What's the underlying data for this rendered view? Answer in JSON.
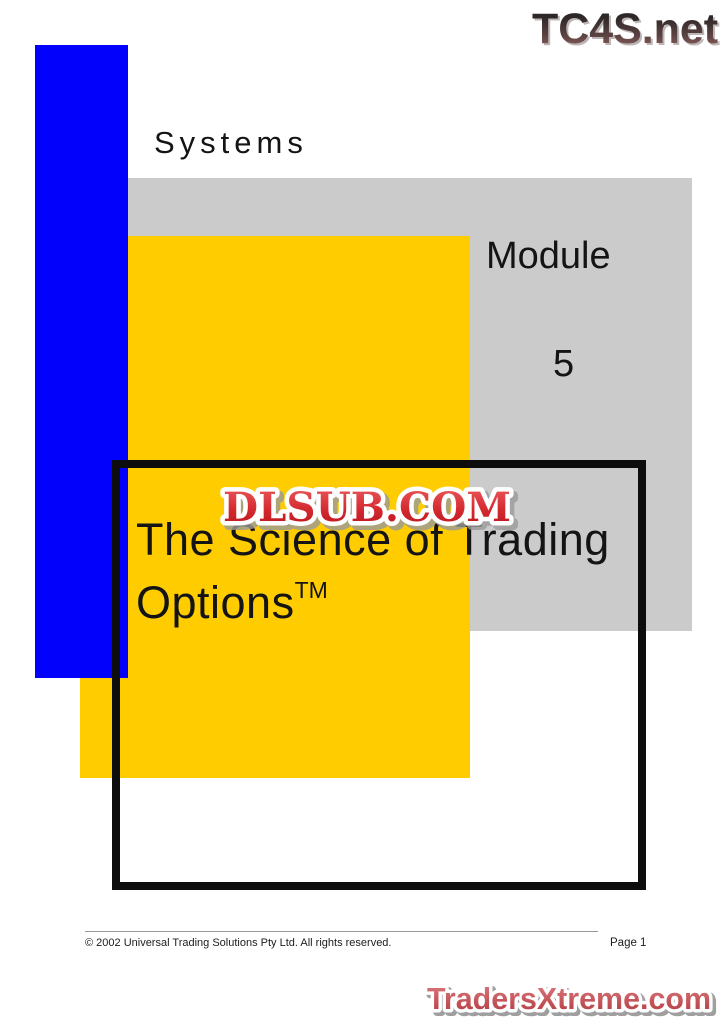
{
  "colors": {
    "accent_blue": "#0202fc",
    "accent_yellow": "#ffcc00",
    "panel_gray": "#cbcbcb",
    "frame_black": "#0d0d0d",
    "text_black": "#141414",
    "footer_gray": "#999999",
    "wm_red_light": "#e85456",
    "wm_red_dark": "#b9121a",
    "tx_red_light": "#d9767a",
    "tx_red_dark": "#b2393f",
    "tc4s_top": "#2e2727",
    "tc4s_bottom": "#a06a66"
  },
  "header": {
    "site_logo": "TC4S.net"
  },
  "slide": {
    "eyebrow": "Systems",
    "module_label": "Module",
    "module_number": "5",
    "title_line1": "The Science of Trading",
    "title_line2": "Options",
    "trademark": "TM"
  },
  "watermark": {
    "center": "DLSUB.COM",
    "bottom": "TradersXtreme.com"
  },
  "footer": {
    "copyright": "© 2002 Universal Trading Solutions Pty Ltd. All rights reserved.",
    "page": "Page 1"
  }
}
